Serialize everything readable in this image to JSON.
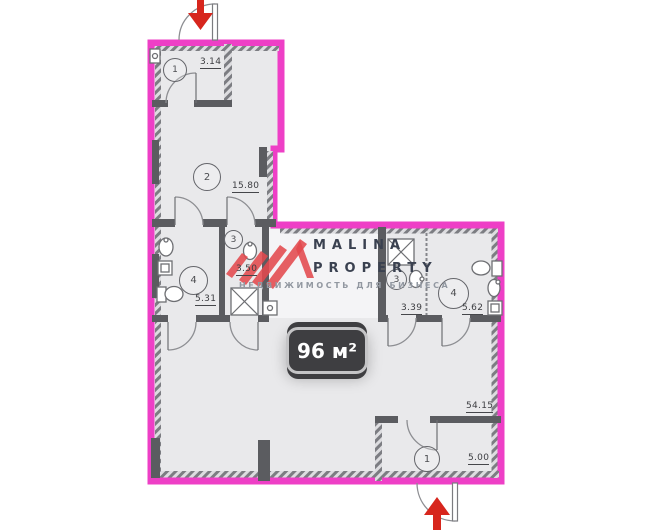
{
  "plan": {
    "total_area": "96 м²",
    "dimension": "54.15",
    "rooms": [
      {
        "number": "1",
        "area": "3.14"
      },
      {
        "number": "2",
        "area": "15.80"
      },
      {
        "number": "3",
        "area": "3.50"
      },
      {
        "number": "4",
        "area": "5.31"
      },
      {
        "number": "3",
        "area": "3.39"
      },
      {
        "number": "4",
        "area": "5.62"
      },
      {
        "number": "1",
        "area": "5.00"
      }
    ]
  },
  "watermark": {
    "line1": "MALINA",
    "line2": "PROPERTY",
    "tagline": "НЕДВИЖИМОСТЬ ДЛЯ БИЗНЕСА"
  },
  "colors": {
    "outline_pink": "#ee3fc6",
    "wall_gray": "#5b5c60",
    "floor": "#e9e9eb",
    "arrow_red": "#d7261d",
    "badge_bg": "#3e3e41",
    "badge_text": "#ffffff",
    "badge_border": "#c4c4c6",
    "watermark_red": "#e2494d",
    "watermark_text": "#3a4150",
    "watermark_tagline": "#9298a1"
  }
}
